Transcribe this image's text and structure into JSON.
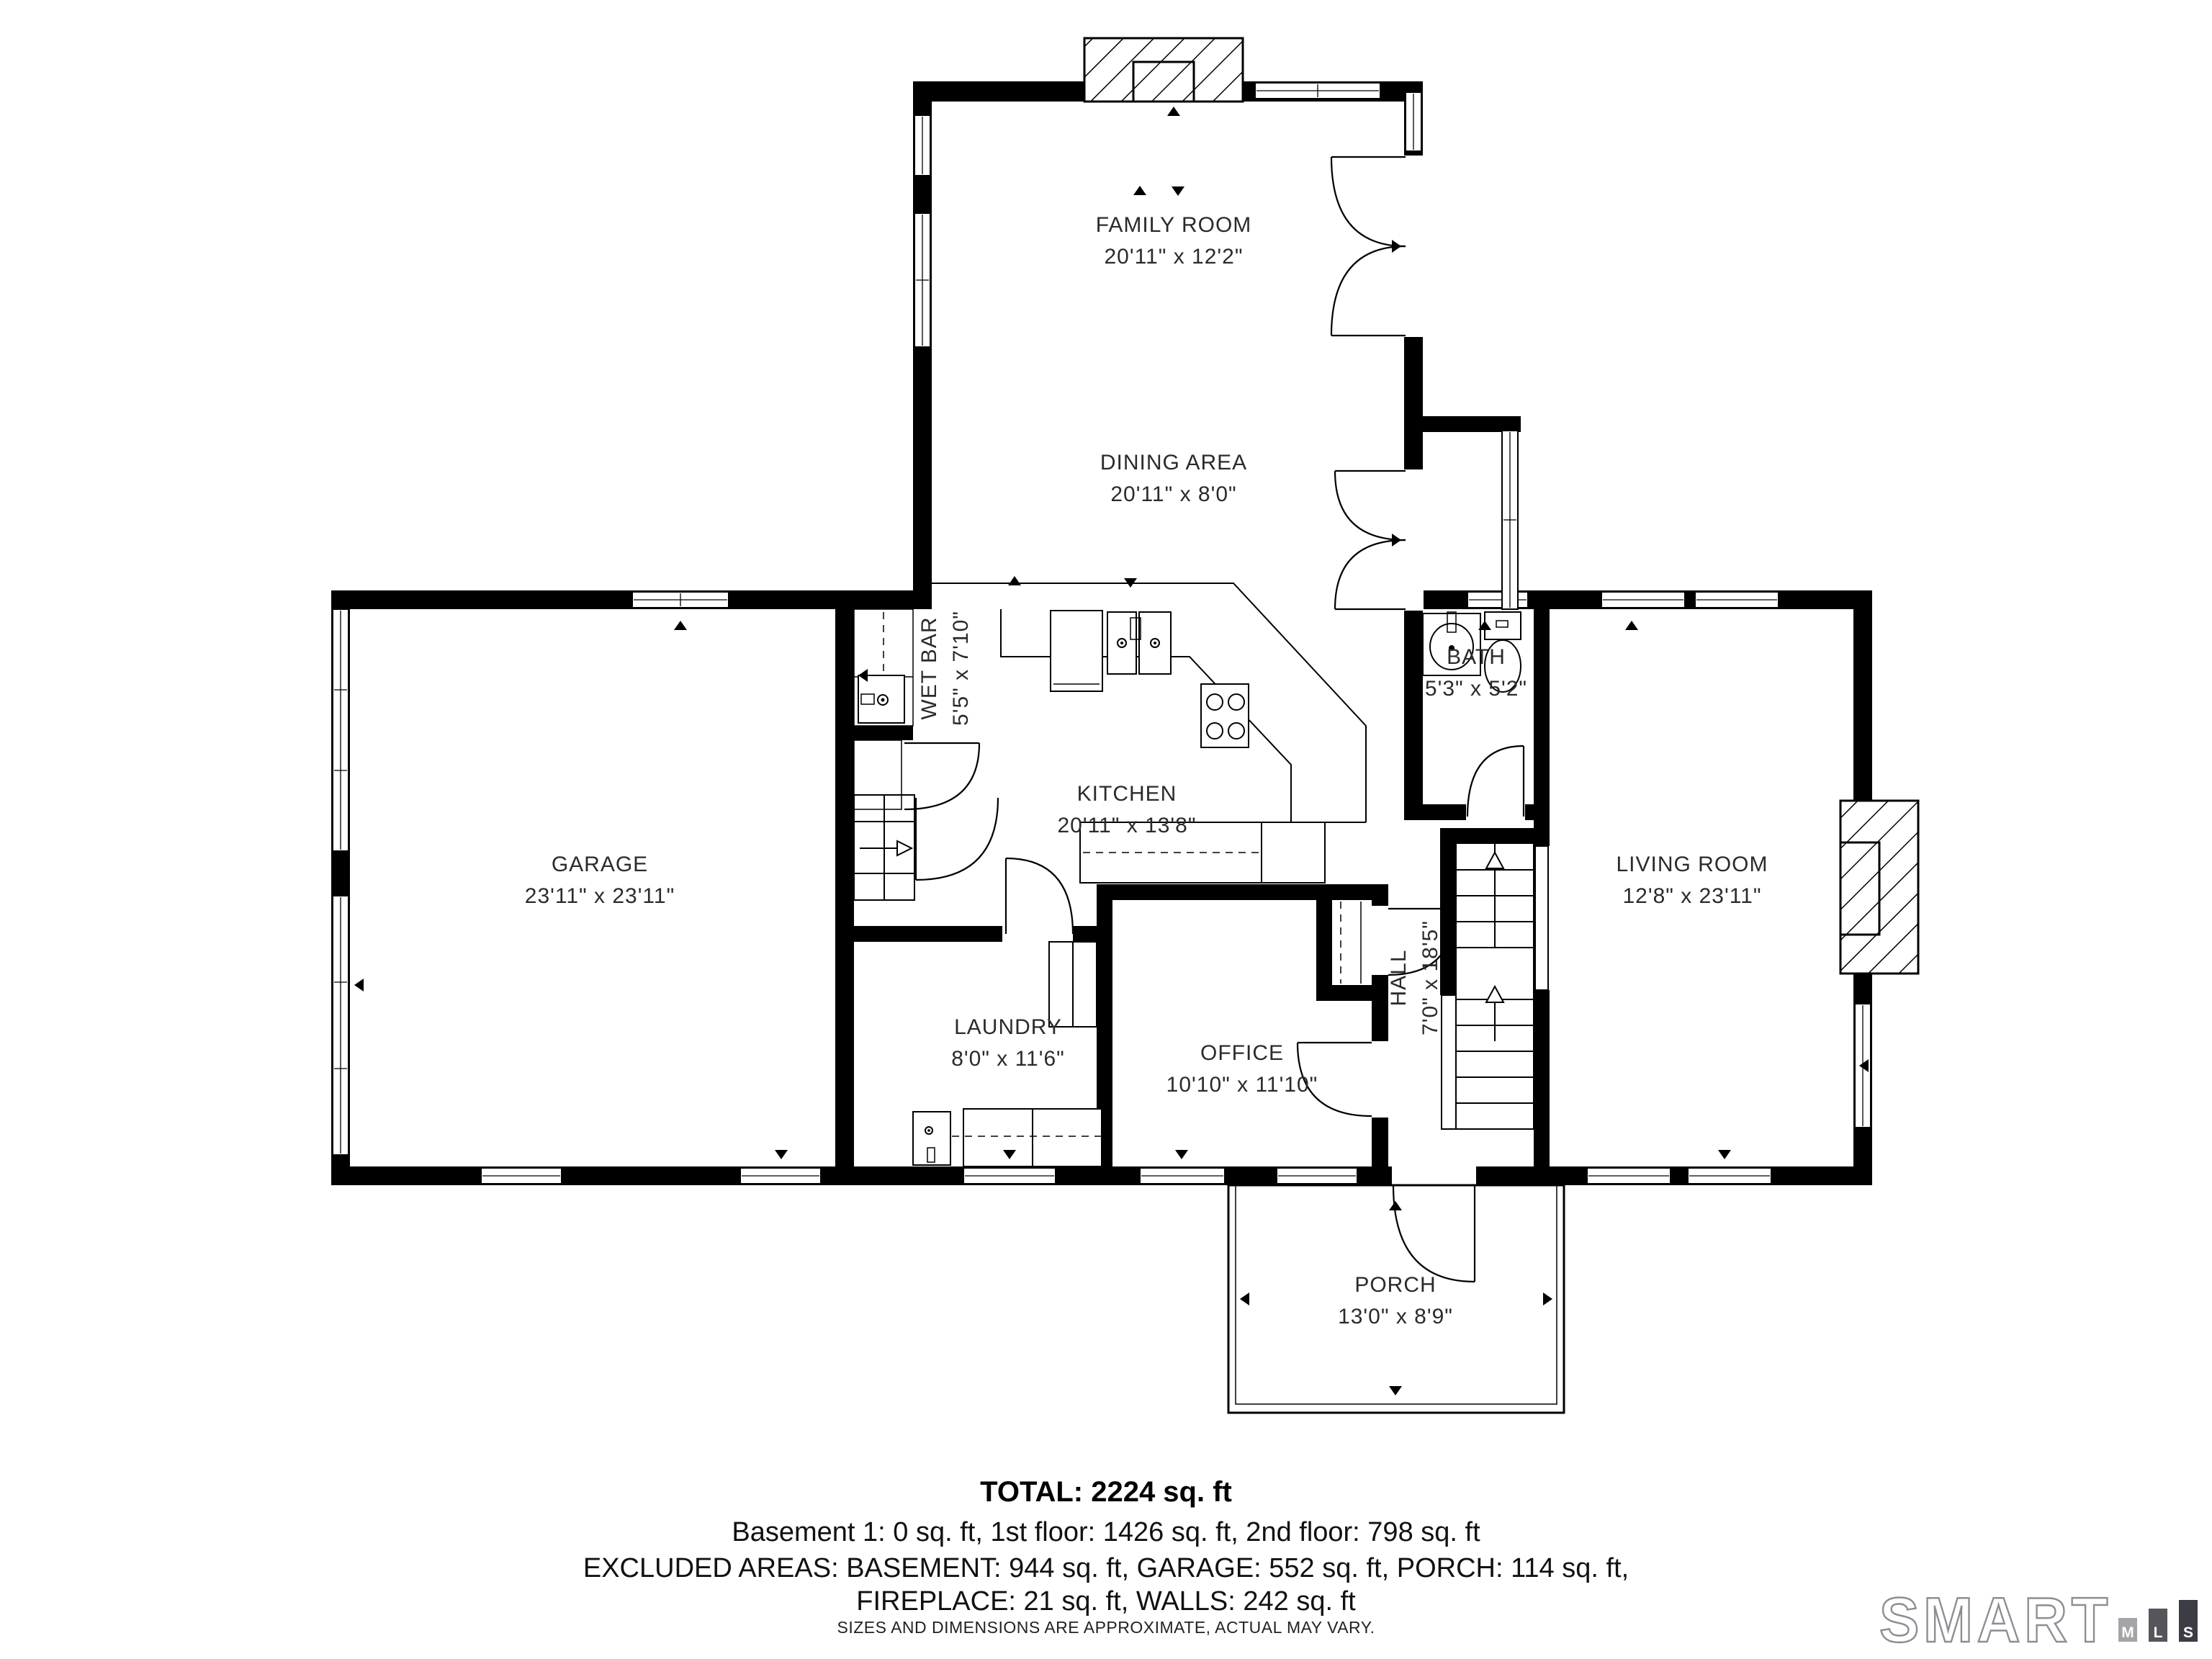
{
  "rooms": {
    "family_room": {
      "name": "FAMILY ROOM",
      "dims": "20'11\" x 12'2\""
    },
    "dining_area": {
      "name": "DINING AREA",
      "dims": "20'11\" x 8'0\""
    },
    "wet_bar": {
      "name": "WET BAR",
      "dims": "5'5\" x 7'10\""
    },
    "kitchen": {
      "name": "KITCHEN",
      "dims": "20'11\" x 13'8\""
    },
    "bath": {
      "name": "BATH",
      "dims": "5'3\" x 5'2\""
    },
    "garage": {
      "name": "GARAGE",
      "dims": "23'11\" x 23'11\""
    },
    "living_room": {
      "name": "LIVING ROOM",
      "dims": "12'8\" x 23'11\""
    },
    "laundry": {
      "name": "LAUNDRY",
      "dims": "8'0\" x 11'6\""
    },
    "office": {
      "name": "OFFICE",
      "dims": "10'10\" x 11'10\""
    },
    "hall": {
      "name": "HALL",
      "dims": "7'0\" x 18'5\""
    },
    "porch": {
      "name": "PORCH",
      "dims": "13'0\" x 8'9\""
    }
  },
  "title_block": {
    "total": "TOTAL: 2224 sq. ft",
    "floors": "Basement 1: 0 sq. ft, 1st floor: 1426 sq. ft, 2nd floor: 798 sq. ft",
    "excluded_1": "EXCLUDED AREAS: BASEMENT: 944 sq. ft, GARAGE: 552 sq. ft, PORCH: 114 sq. ft,",
    "excluded_2": "FIREPLACE: 21 sq. ft, WALLS: 242 sq. ft",
    "disclaimer": "SIZES AND DIMENSIONS ARE APPROXIMATE, ACTUAL MAY VARY."
  },
  "logo": {
    "brand": "SMART",
    "mls": [
      "M",
      "L",
      "S"
    ]
  }
}
